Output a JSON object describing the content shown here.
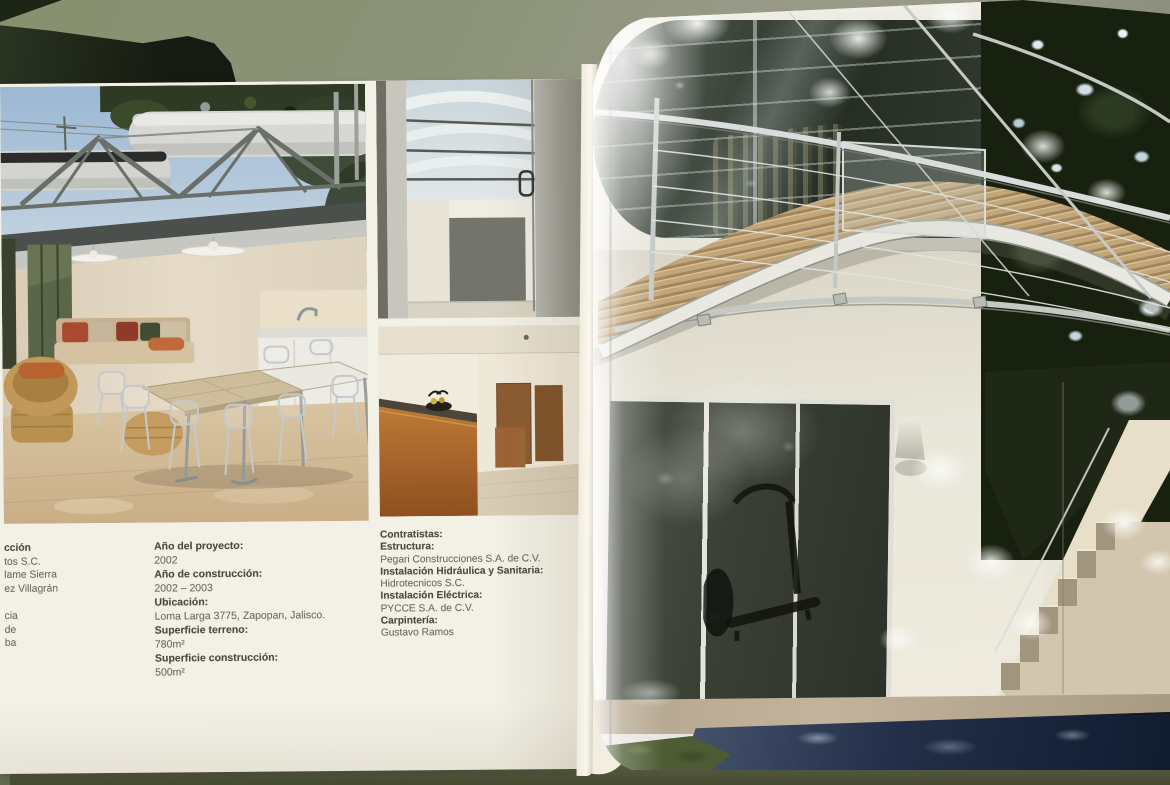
{
  "left_page": {
    "credits_column_fragments": [
      "cción",
      "tos S.C.",
      "lame Sierra",
      "ez Villagrán",
      "",
      "cia",
      "de",
      "ba"
    ],
    "project_details": {
      "rows": [
        {
          "label": "Año del proyecto:",
          "value": "2002"
        },
        {
          "label": "Año de construcción:",
          "value": "2002 – 2003"
        },
        {
          "label": "Ubicación:",
          "value": "Loma Larga 3775, Zapopan, Jalisco."
        },
        {
          "label": "Superficie terreno:",
          "value": "780m²"
        },
        {
          "label": "Superficie construcción:",
          "value": "500m²"
        }
      ]
    },
    "contractors": {
      "title": "Contratistas:",
      "rows": [
        {
          "label": "Estructura:",
          "value": "Pegari Construcciones S.A. de C.V."
        },
        {
          "label": "Instalación Hidráulica y Sanitaria:",
          "value": "Hidrotecnicos S.C."
        },
        {
          "label": "Instalación Eléctrica:",
          "value": "PYCCE S.A. de C.V."
        },
        {
          "label": "Carpintería:",
          "value": "Gustavo Ramos"
        }
      ]
    }
  },
  "colors": {
    "table_surface": "#8a9074",
    "paper": "#f3f0e5",
    "label_text": "#49493f",
    "body_text": "#6f6b62",
    "pool_water": "#22304a",
    "foliage": "#18210f",
    "counter_wood": "#b06c2e"
  }
}
